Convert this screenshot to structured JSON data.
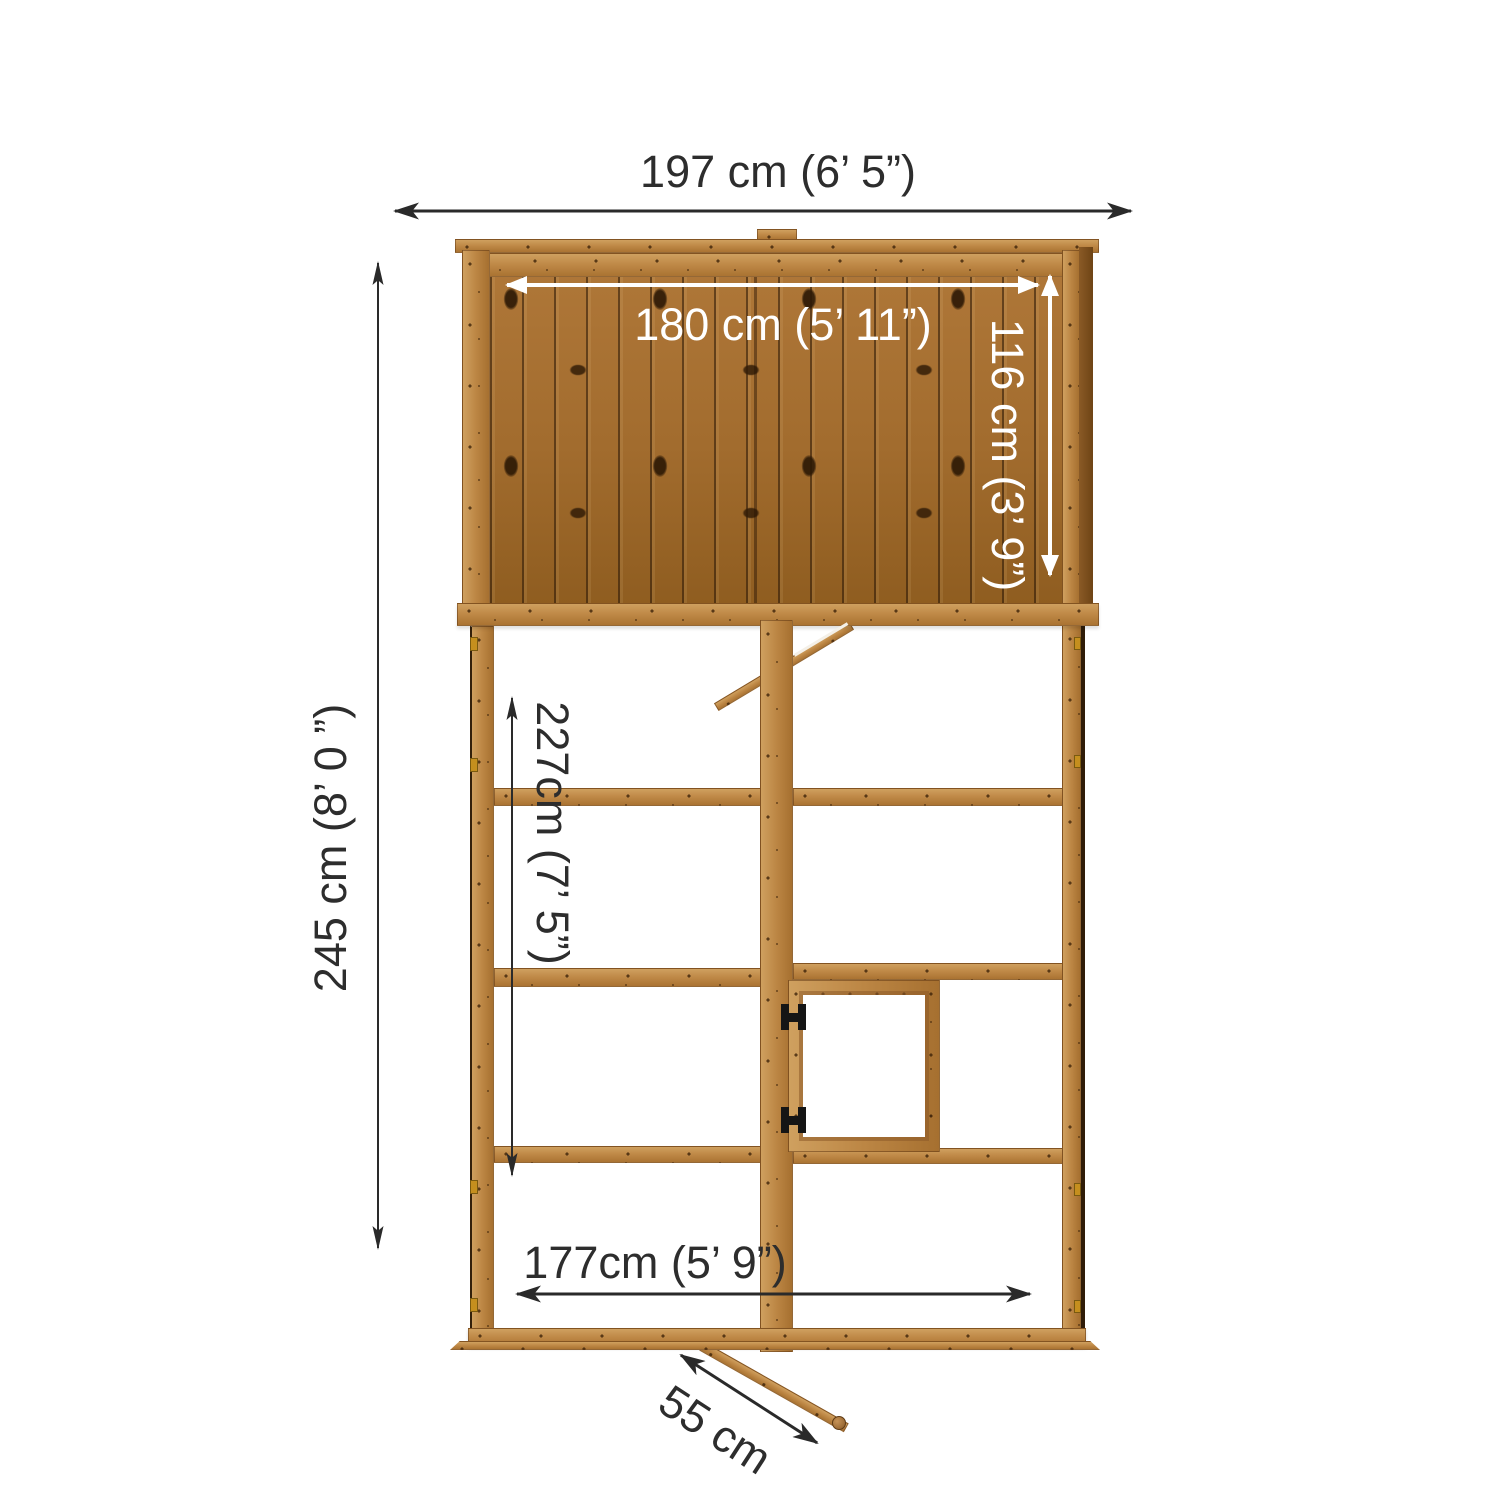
{
  "diagram": {
    "type": "product-dimension-diagram",
    "dimensions": {
      "overall_width": "197 cm (6’ 5”)",
      "panel_width": "180 cm (5’ 11”)",
      "panel_height": "116 cm (3’ 9”)",
      "overall_height": "245 cm (8’ 0 ”)",
      "frame_inner_height": "227cm (7’ 5”)",
      "base_inner_width": "177cm (5’ 9”)",
      "door_width": "55 cm"
    },
    "colors": {
      "background": "#ffffff",
      "dimension_text_dark": "#2d2d2d",
      "dimension_text_light": "#ffffff",
      "arrow_dark": "#2a2a2a",
      "arrow_light": "#ffffff",
      "wood_plank": "#a26c2e",
      "wood_frame": "#bc8644",
      "hinge_black": "#151515",
      "hinge_gold": "#c58f1e"
    }
  }
}
